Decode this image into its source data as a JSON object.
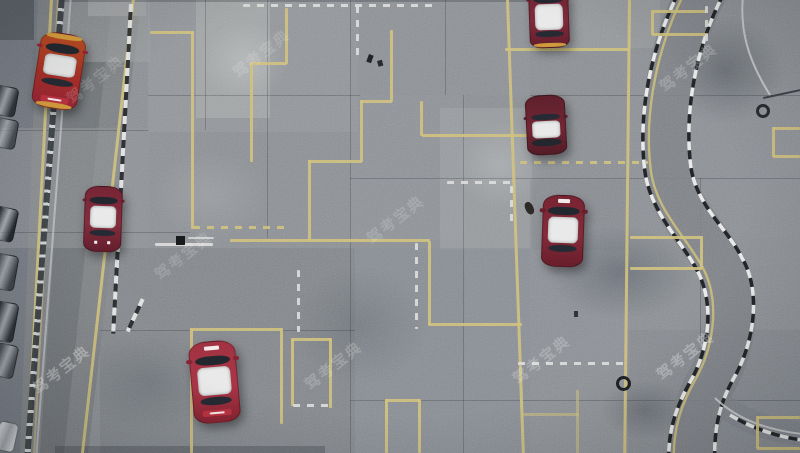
{
  "meta": {
    "title": "Aerial drone photo of a driving-school test course",
    "description": "Top-down view of a concrete driving test field with yellow course lines, white dashed lines, black-and-white curb stones, an S-curve track on the right, red-and-white training sedans, a perimeter road with fence and parked cars on the left, and repeated diagonal watermarks."
  },
  "scene": {
    "width": 800,
    "height": 453,
    "watermark": {
      "text": "驾考宝典",
      "instances": [
        {
          "x": 28,
          "y": 382,
          "rot": -38,
          "o": 0.32
        },
        {
          "x": 62,
          "y": 92,
          "rot": -38,
          "o": 0.14
        },
        {
          "x": 150,
          "y": 268,
          "rot": -38,
          "o": 0.16
        },
        {
          "x": 228,
          "y": 66,
          "rot": -38,
          "o": 0.15
        },
        {
          "x": 300,
          "y": 378,
          "rot": -38,
          "o": 0.2
        },
        {
          "x": 362,
          "y": 232,
          "rot": -38,
          "o": 0.16
        },
        {
          "x": 508,
          "y": 372,
          "rot": -38,
          "o": 0.22
        },
        {
          "x": 655,
          "y": 80,
          "rot": -38,
          "o": 0.2
        },
        {
          "x": 652,
          "y": 368,
          "rot": -38,
          "o": 0.3
        }
      ]
    },
    "ground": {
      "base": "#8a8e92",
      "outer_strip": {
        "clip": "0,0 40,0 22,453 0,453",
        "c": "#737880"
      },
      "road": {
        "clip": "38,0 141,0 88,453 20,453",
        "c": "#7d8083"
      },
      "road_wear": {
        "clip": "70,0 112,0 64,453 40,453",
        "c": "rgba(58,61,65,0.18)"
      },
      "patches": [
        {
          "x": 148,
          "y": 0,
          "w": 210,
          "h": 132,
          "c": "#94979b",
          "o": 0.7
        },
        {
          "x": 196,
          "y": 0,
          "w": 74,
          "h": 118,
          "c": "#a4a6a8",
          "o": 0.8
        },
        {
          "x": 58,
          "y": 0,
          "w": 92,
          "h": 62,
          "c": "#999c9f",
          "o": 0.6
        },
        {
          "x": 88,
          "y": 0,
          "w": 58,
          "h": 16,
          "c": "#9fa1a3",
          "o": 0.9
        },
        {
          "x": 0,
          "y": 0,
          "w": 34,
          "h": 40,
          "c": "#565b61",
          "o": 0.9
        },
        {
          "x": 350,
          "y": 0,
          "w": 180,
          "h": 95,
          "c": "#8e9196",
          "o": 0.6
        },
        {
          "x": 530,
          "y": 0,
          "w": 130,
          "h": 48,
          "c": "#979a9d",
          "o": 0.7
        },
        {
          "x": 0,
          "y": 128,
          "w": 150,
          "h": 120,
          "c": "#8f9295",
          "o": 0.5
        },
        {
          "x": 148,
          "y": 132,
          "w": 202,
          "h": 116,
          "c": "#8c9094",
          "o": 0.5
        },
        {
          "x": 350,
          "y": 95,
          "w": 115,
          "h": 145,
          "c": "#90939a",
          "o": 0.5
        },
        {
          "x": 440,
          "y": 108,
          "w": 92,
          "h": 142,
          "c": "#9da0a4",
          "o": 0.6
        },
        {
          "x": 100,
          "y": 248,
          "w": 255,
          "h": 205,
          "c": "#7f8388",
          "o": 0.7
        },
        {
          "x": 355,
          "y": 248,
          "w": 175,
          "h": 205,
          "c": "#868a92",
          "o": 0.6
        },
        {
          "x": 628,
          "y": 88,
          "w": 172,
          "h": 150,
          "c": "#8b8f96",
          "o": 0.5
        },
        {
          "x": 628,
          "y": 330,
          "w": 172,
          "h": 123,
          "c": "#82868c",
          "o": 0.6
        },
        {
          "x": 465,
          "y": 250,
          "w": 165,
          "h": 120,
          "c": "#8b8e95",
          "o": 0.5
        },
        {
          "x": 530,
          "y": 180,
          "w": 100,
          "h": 70,
          "c": "#84888e",
          "o": 0.5
        }
      ],
      "stains": [
        {
          "x": 545,
          "y": 225,
          "w": 150,
          "h": 95,
          "c": "rgba(55,62,75,0.35)"
        },
        {
          "x": 665,
          "y": 15,
          "w": 120,
          "h": 110,
          "c": "rgba(60,64,70,0.40)"
        },
        {
          "x": 200,
          "y": 20,
          "w": 90,
          "h": 80,
          "c": "rgba(230,232,233,0.25)"
        },
        {
          "x": 455,
          "y": 120,
          "w": 90,
          "h": 90,
          "c": "rgba(225,227,230,0.22)"
        },
        {
          "x": 290,
          "y": 265,
          "w": 140,
          "h": 120,
          "c": "rgba(70,76,86,0.25)"
        },
        {
          "x": 80,
          "y": 330,
          "w": 140,
          "h": 100,
          "c": "rgba(65,70,78,0.22)"
        },
        {
          "x": 600,
          "y": 380,
          "w": 90,
          "h": 60,
          "c": "rgba(50,55,62,0.30)"
        },
        {
          "x": 150,
          "y": 150,
          "w": 120,
          "h": 90,
          "c": "rgba(220,222,224,0.15)"
        }
      ],
      "seams": [
        {
          "x": 205,
          "y": 0,
          "w": 1,
          "h": 130
        },
        {
          "x": 267,
          "y": 0,
          "w": 1,
          "h": 238
        },
        {
          "x": 350,
          "y": 0,
          "w": 1,
          "h": 453
        },
        {
          "x": 445,
          "y": 0,
          "w": 1,
          "h": 95
        },
        {
          "x": 463,
          "y": 95,
          "w": 1,
          "h": 358
        },
        {
          "x": 700,
          "y": 178,
          "w": 1,
          "h": 175
        },
        {
          "x": 148,
          "y": 95,
          "w": 212,
          "h": 1
        },
        {
          "x": 0,
          "y": 130,
          "w": 148,
          "h": 1
        },
        {
          "x": 350,
          "y": 178,
          "w": 450,
          "h": 1
        },
        {
          "x": 530,
          "y": 95,
          "w": 270,
          "h": 1
        },
        {
          "x": 0,
          "y": 232,
          "w": 190,
          "h": 1
        },
        {
          "x": 100,
          "y": 330,
          "w": 255,
          "h": 1
        },
        {
          "x": 350,
          "y": 400,
          "w": 450,
          "h": 1
        },
        {
          "x": 60,
          "y": 0,
          "w": 470,
          "h": 2
        },
        {
          "x": 55,
          "y": 446,
          "w": 270,
          "h": 7
        }
      ]
    },
    "fence": {
      "x": 59,
      "y": -5,
      "w": 6,
      "h": 470,
      "rot": 4.3
    },
    "guardrail": {
      "x": 70,
      "y": -5,
      "w": 2,
      "h": 470,
      "rot": 4.3
    },
    "lines": {
      "yellow_color": "#cdbe78",
      "white_color": "#dadbd9",
      "yellow": [
        {
          "x": 150,
          "y": 31,
          "w": 44,
          "h": 2.5
        },
        {
          "x": 191,
          "y": 31,
          "w": 2.5,
          "h": 198
        },
        {
          "x": 193,
          "y": 226,
          "w": 95,
          "h": 2.5,
          "d": 1
        },
        {
          "x": 285,
          "y": 8,
          "w": 2.5,
          "h": 56
        },
        {
          "x": 250,
          "y": 62,
          "w": 37,
          "h": 2.5
        },
        {
          "x": 250,
          "y": 62,
          "w": 2.5,
          "h": 100
        },
        {
          "x": 390,
          "y": 30,
          "w": 2.5,
          "h": 72
        },
        {
          "x": 360,
          "y": 100,
          "w": 32,
          "h": 2.5
        },
        {
          "x": 360,
          "y": 100,
          "w": 2.5,
          "h": 62
        },
        {
          "x": 308,
          "y": 160,
          "w": 54,
          "h": 2.5
        },
        {
          "x": 308,
          "y": 160,
          "w": 2.5,
          "h": 80
        },
        {
          "x": 230,
          "y": 239,
          "w": 200,
          "h": 2.5
        },
        {
          "x": 428,
          "y": 241,
          "w": 2.5,
          "h": 84
        },
        {
          "x": 428,
          "y": 323,
          "w": 94,
          "h": 2.5
        },
        {
          "x": 420,
          "y": 101,
          "w": 2.5,
          "h": 35
        },
        {
          "x": 422,
          "y": 134,
          "w": 105,
          "h": 2.5
        },
        {
          "x": 505,
          "y": 48,
          "w": 124,
          "h": 2.5
        },
        {
          "x": 520,
          "y": 161,
          "w": 128,
          "h": 2.5,
          "d": 1
        },
        {
          "x": 630,
          "y": 236,
          "w": 72,
          "h": 2.5
        },
        {
          "x": 630,
          "y": 267,
          "w": 72,
          "h": 2.5
        },
        {
          "x": 700,
          "y": 236,
          "w": 2.5,
          "h": 33
        },
        {
          "x": 652,
          "y": 10,
          "w": 56,
          "h": 2.5
        },
        {
          "x": 652,
          "y": 33,
          "w": 56,
          "h": 2.5
        },
        {
          "x": 651,
          "y": 10,
          "w": 2.5,
          "h": 25
        },
        {
          "x": 773,
          "y": 127,
          "w": 27,
          "h": 2.5
        },
        {
          "x": 773,
          "y": 155,
          "w": 27,
          "h": 2.5
        },
        {
          "x": 772,
          "y": 127,
          "w": 2.5,
          "h": 30
        },
        {
          "x": 757,
          "y": 416,
          "w": 43,
          "h": 2.5
        },
        {
          "x": 757,
          "y": 447,
          "w": 43,
          "h": 2.5
        },
        {
          "x": 756,
          "y": 416,
          "w": 2.5,
          "h": 33
        },
        {
          "x": 190,
          "y": 328,
          "w": 92,
          "h": 2.5
        },
        {
          "x": 190,
          "y": 328,
          "w": 2.5,
          "h": 125
        },
        {
          "x": 280,
          "y": 328,
          "w": 2.5,
          "h": 96
        },
        {
          "x": 291,
          "y": 338,
          "w": 40,
          "h": 2.5
        },
        {
          "x": 291,
          "y": 338,
          "w": 2.5,
          "h": 68
        },
        {
          "x": 329,
          "y": 338,
          "w": 2.5,
          "h": 70
        },
        {
          "x": 385,
          "y": 399,
          "w": 35,
          "h": 2.5
        },
        {
          "x": 385,
          "y": 399,
          "w": 2.5,
          "h": 54
        },
        {
          "x": 418,
          "y": 399,
          "w": 2.5,
          "h": 54
        },
        {
          "x": 523,
          "y": 413,
          "w": 56,
          "h": 2.5,
          "o": 0.55
        },
        {
          "x": 576,
          "y": 390,
          "w": 2.5,
          "h": 63,
          "o": 0.55
        },
        {
          "x": 506,
          "y": 0,
          "w": 2.5,
          "h": 456,
          "rot": -2.0
        },
        {
          "x": 628,
          "y": 0,
          "w": 2.5,
          "h": 456,
          "rot": 0.6
        },
        {
          "x": 50,
          "y": -2,
          "w": 2.5,
          "h": 458,
          "rot": 3.0
        },
        {
          "x": 57,
          "y": -2,
          "w": 2,
          "h": 458,
          "rot": 3.0,
          "o": 0.55
        },
        {
          "x": 132,
          "y": -2,
          "w": 2.5,
          "h": 458,
          "rot": 6.4
        }
      ],
      "white": [
        {
          "x": 243,
          "y": 4,
          "w": 190,
          "h": 2.5,
          "d": 1
        },
        {
          "x": 356,
          "y": 6,
          "w": 2.5,
          "h": 54,
          "d": 1
        },
        {
          "x": 415,
          "y": 243,
          "w": 2.5,
          "h": 86,
          "d": 1
        },
        {
          "x": 510,
          "y": 186,
          "w": 2.5,
          "h": 36,
          "d": 1
        },
        {
          "x": 518,
          "y": 362,
          "w": 112,
          "h": 2.5,
          "d": 1
        },
        {
          "x": 155,
          "y": 243,
          "w": 58,
          "h": 2.5
        },
        {
          "x": 188,
          "y": 237,
          "w": 26,
          "h": 2,
          "o": 0.8
        },
        {
          "x": 297,
          "y": 270,
          "w": 2.5,
          "h": 62,
          "d": 1
        },
        {
          "x": 705,
          "y": 6,
          "w": 2.5,
          "h": 40,
          "d": 1
        },
        {
          "x": 447,
          "y": 181,
          "w": 66,
          "h": 2.5,
          "d": 1
        },
        {
          "x": 293,
          "y": 404,
          "w": 38,
          "h": 2.5,
          "d": 1
        }
      ],
      "curbs": [
        {
          "x": 129,
          "y": 4,
          "w": 4,
          "h": 330,
          "rot": 3.1
        },
        {
          "x": 141,
          "y": 298,
          "w": 4,
          "h": 36,
          "rot": 25
        }
      ]
    },
    "s_curve": {
      "center": "M 85,-14 C 55,40 40,110 48,170 C 54,210 85,235 100,265 C 118,298 112,345 92,380 C 78,405 70,430 72,467",
      "left": "M 62,-14 C 32,42 17,112 25,172 C 31,214 63,242 78,272 C 95,306 89,350 69,384 C 56,408 47,432 49,467",
      "right": "M 108,-14 C 78,38 63,108 71,168 C 77,206 107,228 122,258 C 141,290 135,340 115,376 C 100,402 93,428 95,467",
      "yellow": "M 68,-14 C 38,42 23,112 31,172 C 37,212 69,240 84,270 C 100,303 94,348 74,382 C 61,406 52,430 54,467",
      "branch": "M 95,398 C 118,420 148,430 182,434",
      "branch_curb": "M 110,415 C 135,430 160,437 182,440",
      "top_right_line": "M 150,95 C 128,60 118,28 124,-12"
    },
    "cars": [
      {
        "x": 36,
        "y": 33,
        "w": 46,
        "h": 76,
        "rot": 9,
        "b": [
          "#b5491f",
          "#a22c25",
          "#8e2133"
        ],
        "ws": 15,
        "rt": 29,
        "rh": 28,
        "rw": 60,
        "extras": [
          "bumperTop",
          "bumperBottom",
          "rearBand"
        ]
      },
      {
        "x": 84,
        "y": 186,
        "w": 38,
        "h": 66,
        "rot": 2,
        "b": [
          "#6f2232",
          "#7c2a39",
          "#5e1c2a"
        ],
        "ws": 16,
        "rt": 30,
        "rh": 34,
        "rw": 66,
        "extras": [
          "rearDots"
        ]
      },
      {
        "x": 529,
        "y": -12,
        "w": 40,
        "h": 60,
        "rot": -2,
        "b": [
          "#6b2130",
          "#782737",
          "#5c1c29"
        ],
        "ws": 14,
        "rt": 26,
        "rh": 44,
        "rw": 72,
        "extras": [
          "bumperBottom"
        ]
      },
      {
        "x": 526,
        "y": 95,
        "w": 40,
        "h": 60,
        "rot": -3,
        "b": [
          "#581e29",
          "#6b2331",
          "#4d1a24"
        ],
        "ws": 74,
        "rt": 44,
        "rh": 28,
        "rw": 32,
        "extras": []
      },
      {
        "x": 542,
        "y": 195,
        "w": 42,
        "h": 72,
        "rot": 2,
        "b": [
          "#71212f",
          "#7d2836",
          "#621b28"
        ],
        "ws": 17,
        "rt": 31,
        "rh": 36,
        "rw": 69,
        "extras": [
          "hoodText"
        ]
      },
      {
        "x": 191,
        "y": 341,
        "w": 47,
        "h": 82,
        "rot": -5,
        "b": [
          "#9b2f3d",
          "#a33242",
          "#7f212e"
        ],
        "ws": 18,
        "rt": 32,
        "rh": 34,
        "rw": 68,
        "extras": [
          "hoodText",
          "rearBand"
        ]
      }
    ],
    "parked_vehicles": [
      {
        "x": -6,
        "y": 84,
        "w": 26,
        "h": 30,
        "c": "#2c3138",
        "rot": 10
      },
      {
        "x": -8,
        "y": 116,
        "w": 28,
        "h": 30,
        "c": "#41474d",
        "rot": 10
      },
      {
        "x": -4,
        "y": 205,
        "w": 24,
        "h": 34,
        "c": "#23282e",
        "rot": 12
      },
      {
        "x": -6,
        "y": 252,
        "w": 26,
        "h": 36,
        "c": "#3a3f46",
        "rot": 10
      },
      {
        "x": -4,
        "y": 300,
        "w": 24,
        "h": 40,
        "c": "#2a2f36",
        "rot": 10
      },
      {
        "x": -2,
        "y": 342,
        "w": 22,
        "h": 34,
        "c": "#454a50",
        "rot": 12
      },
      {
        "x": 0,
        "y": 420,
        "w": 20,
        "h": 30,
        "c": "#c7cacc",
        "rot": 12
      }
    ],
    "objects": [
      {
        "t": "rect",
        "x": 176,
        "y": 236,
        "w": 9,
        "h": 9,
        "c": "#17181a"
      },
      {
        "t": "rect",
        "x": 369,
        "y": 54,
        "w": 5,
        "h": 8,
        "c": "#202124",
        "rot": 20
      },
      {
        "t": "rect",
        "x": 377,
        "y": 61,
        "w": 5,
        "h": 6,
        "c": "#26282b",
        "rot": -15
      },
      {
        "t": "person",
        "x": 523,
        "y": 204,
        "w": 8,
        "h": 13,
        "c": "#2b2724",
        "rot": -25
      },
      {
        "t": "rect",
        "x": 574,
        "y": 311,
        "w": 4,
        "h": 6,
        "c": "#2e3033"
      },
      {
        "t": "ring",
        "x": 616,
        "y": 376,
        "w": 15,
        "h": 15,
        "c": "#1d1f22"
      },
      {
        "t": "ring",
        "x": 756,
        "y": 104,
        "w": 14,
        "h": 14,
        "c": "#26292d"
      },
      {
        "t": "rect",
        "x": 763,
        "y": 97,
        "w": 38,
        "h": 2,
        "c": "#3c4045",
        "rot": -12
      }
    ]
  }
}
